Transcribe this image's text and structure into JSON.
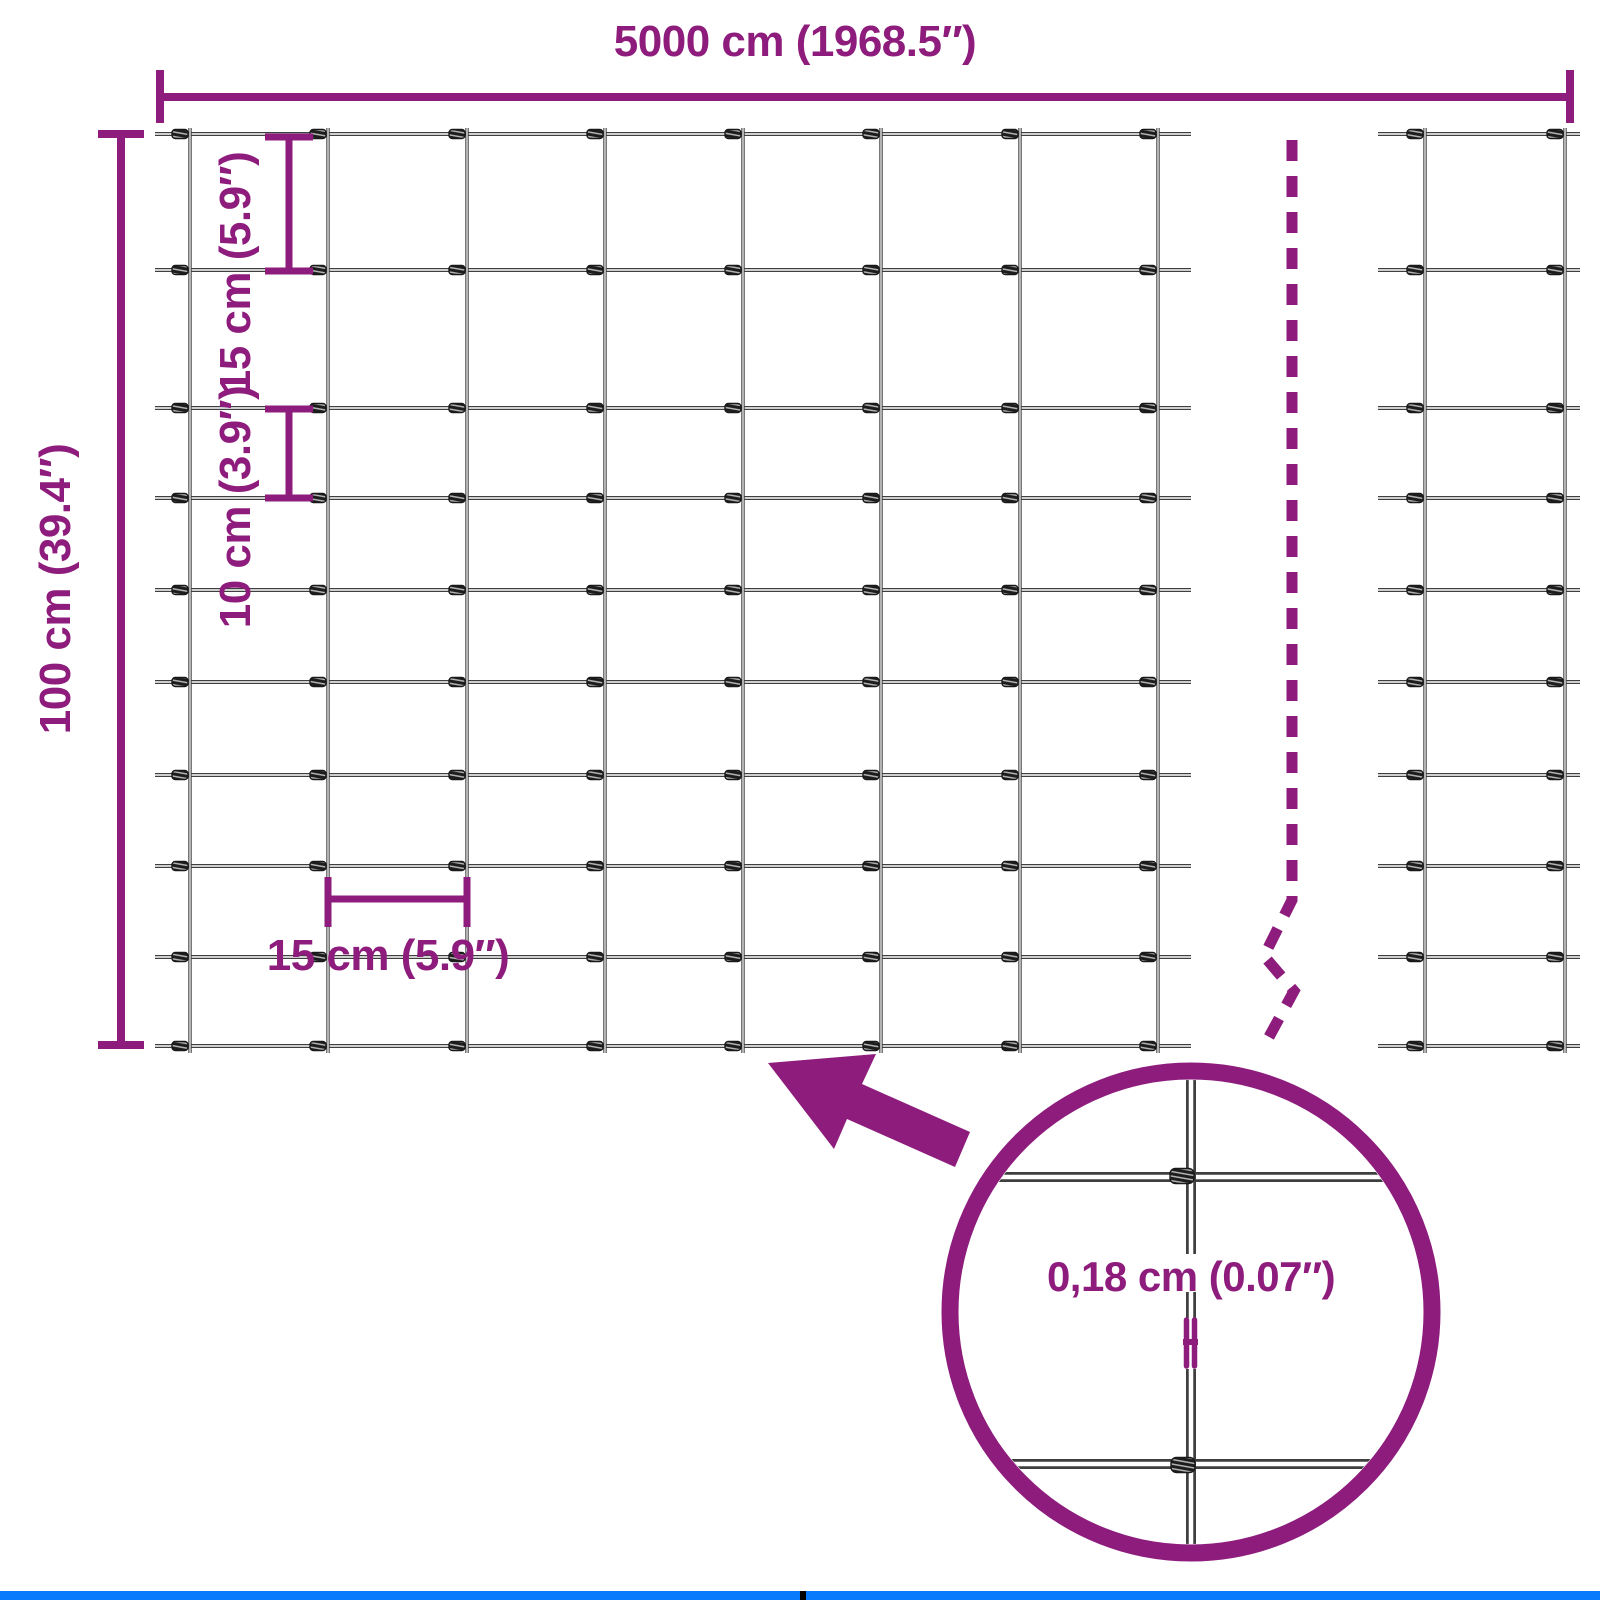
{
  "colors": {
    "accent": "#8D1C7C",
    "wire": "#3F3F3F",
    "wire_core": "#FFFFFF",
    "knot_dark": "#1C1C1C",
    "knot_light": "#B5B5B5",
    "bar_blue": "#077BFB",
    "bar_divider": "#000000",
    "background": "#FFFFFF"
  },
  "labels": {
    "total_width": "5000 cm (1968.5″)",
    "total_height": "100 cm (39.4″)",
    "cell_height_top": "15 cm (5.9″)",
    "cell_height_mid": "10 cm (3.9″)",
    "cell_width": "15 cm (5.9″)",
    "wire_diameter": "0,18 cm (0.07″)"
  },
  "mesh": {
    "kind": "wire-fence-mesh",
    "row_spacings_cm": [
      15,
      15,
      10,
      10,
      10,
      10,
      10,
      10,
      10
    ],
    "column_spacing_cm": 15,
    "total_height_cm": 100,
    "total_width_cm": 5000,
    "wire_diameter_cm": 0.18
  },
  "geometry": {
    "canvas": {
      "w": 1600,
      "h": 1600
    },
    "mesh_rows_y": [
      134,
      270,
      408,
      498,
      590,
      682,
      775,
      866,
      957,
      1046
    ],
    "mesh_main": {
      "cols_x": [
        190,
        328,
        467,
        605,
        743,
        881,
        1020,
        1158
      ],
      "x_start": 155,
      "x_end": 1191,
      "y_start": 128,
      "y_end": 1053
    },
    "mesh_right": {
      "cols_x": [
        1425,
        1565
      ],
      "x_start": 1378,
      "x_end": 1580,
      "y_start": 128,
      "y_end": 1053
    },
    "dim_width": {
      "y": 97,
      "x1": 160,
      "x2": 1570,
      "tick_y1": 70,
      "tick_y2": 123,
      "w": 8
    },
    "dim_height": {
      "x": 121,
      "y1": 134,
      "y2": 1045,
      "tick_x1": 98,
      "tick_x2": 144,
      "w": 8
    },
    "bracket_top": {
      "x": 289,
      "y1": 137,
      "y2": 271,
      "tick_x1": 265,
      "tick_x2": 313,
      "w": 7
    },
    "bracket_mid": {
      "x": 289,
      "y1": 409,
      "y2": 498,
      "tick_x1": 265,
      "tick_x2": 313,
      "w": 7
    },
    "bracket_cell": {
      "y": 899,
      "x1": 328,
      "x2": 467,
      "tick_y1": 877,
      "tick_y2": 927,
      "w": 7
    },
    "break_line": {
      "points": [
        [
          1292,
          140
        ],
        [
          1292,
          900
        ],
        [
          1264,
          956
        ],
        [
          1294,
          991
        ],
        [
          1263,
          1048
        ]
      ],
      "width": 11,
      "dash": [
        21,
        15
      ]
    },
    "detail_circle": {
      "cx": 1191,
      "cy": 1312,
      "r": 241,
      "stroke": 17,
      "clip_r": 232,
      "h_wires_y": [
        1177,
        1464
      ],
      "h_x1": 950,
      "h_x2": 1432,
      "v_x": 1191,
      "v_segments": [
        [
          1072,
          1254
        ],
        [
          1292,
          1318
        ],
        [
          1369,
          1552
        ]
      ],
      "knots": [
        [
          1182,
          1176
        ],
        [
          1183,
          1465
        ]
      ],
      "h_symbol": {
        "left_x": 1186.5,
        "right_x": 1194.5,
        "y1": 1320,
        "y2": 1366,
        "bar_w": 5.5,
        "cross_y": 1342,
        "cross_x1": 1183,
        "cross_x2": 1198
      }
    },
    "arrow_points": [
      [
        768,
        1063
      ],
      [
        876,
        1054
      ],
      [
        862,
        1084
      ],
      [
        970,
        1132
      ],
      [
        955,
        1167
      ],
      [
        847,
        1119
      ],
      [
        834,
        1149
      ]
    ],
    "labels_pos": {
      "total_width": {
        "cx": 795,
        "cy": 42,
        "rot": false
      },
      "total_height": {
        "cx": 56,
        "cy": 589,
        "rot": true
      },
      "cell_height_top": {
        "cx": 236,
        "cy": 273,
        "rot": true
      },
      "cell_height_mid": {
        "cx": 236,
        "cy": 507,
        "rot": true
      },
      "cell_width": {
        "cx": 388,
        "cy": 956,
        "rot": false
      },
      "wire_diameter": {
        "cx": 1191,
        "cy": 1277,
        "rot": false
      }
    },
    "bottom_bar": {
      "h": 9,
      "divider_x": 800,
      "divider_w": 6
    }
  }
}
